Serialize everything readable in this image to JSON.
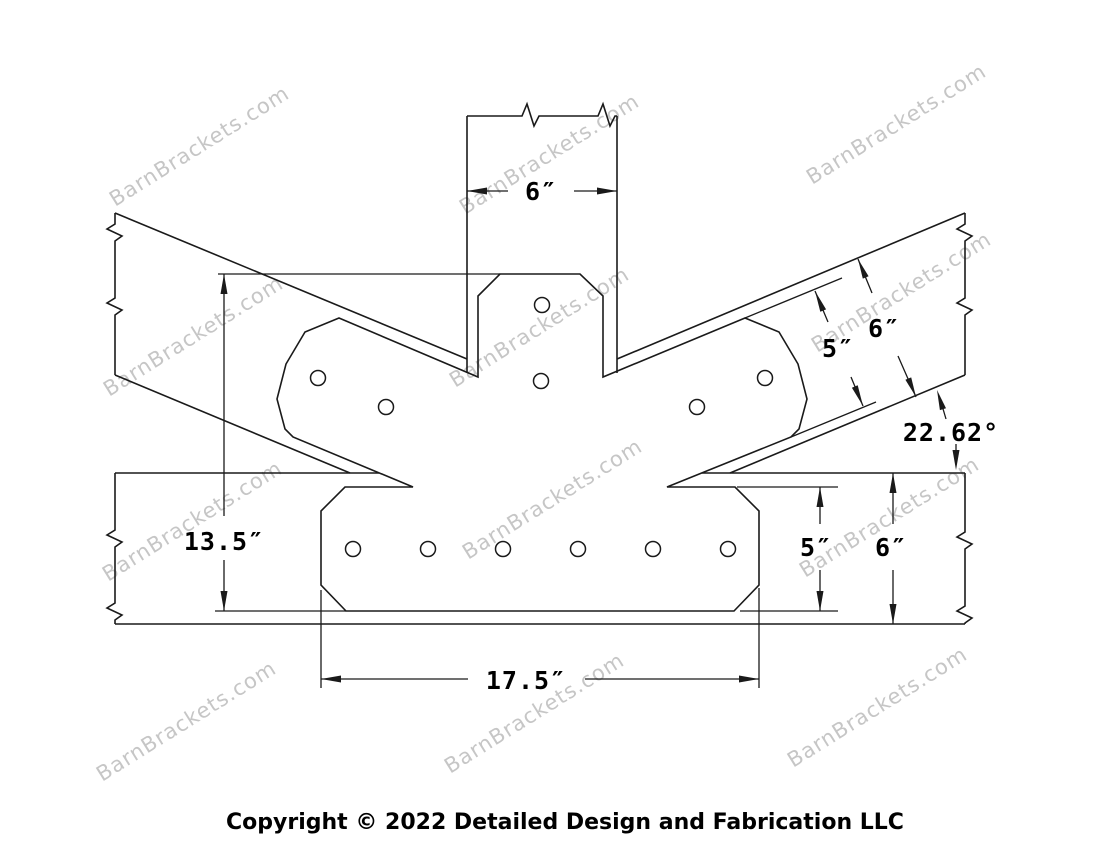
{
  "drawing": {
    "description": "Timber truss bracket technical drawing - T-shaped steel bracket joining a vertical post, two angled rafters and a horizontal beam",
    "labels": {
      "post_width": "6″",
      "rafter_plate_width": "5″",
      "rafter_depth": "6″",
      "pitch_angle": "22.62°",
      "overall_height": "13.5″",
      "beam_plate_width": "5″",
      "beam_depth": "6″",
      "plate_length": "17.5″"
    }
  },
  "watermark": {
    "text": "BarnBrackets.com"
  },
  "footer": {
    "copyright": "Copyright © 2022 Detailed Design and Fabrication LLC"
  },
  "colors": {
    "line": "#1a1a1a",
    "watermark": "#c6c6c6",
    "background": "#ffffff"
  }
}
